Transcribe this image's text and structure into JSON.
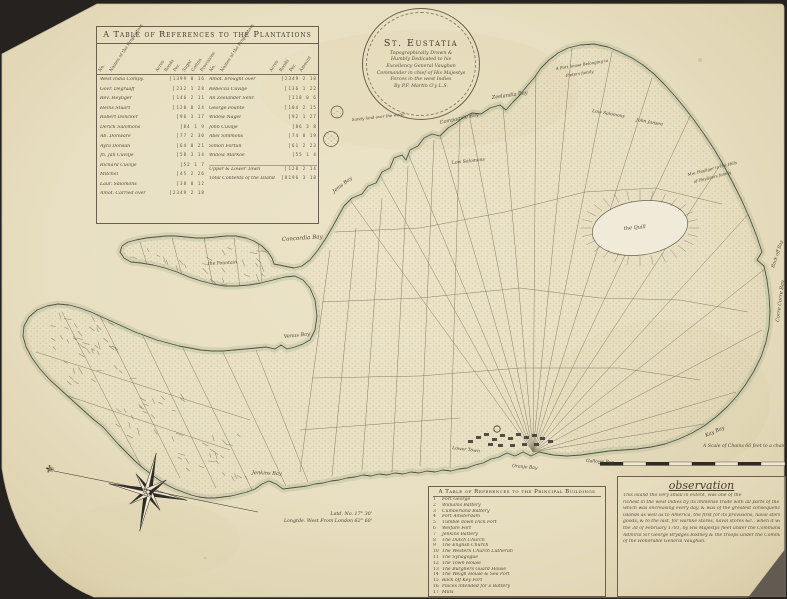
{
  "colors": {
    "paper": "#e9e0c4",
    "ink": "#4d4536",
    "backdrop": "#262220",
    "coast_wash": "#9fae8d"
  },
  "plantation_table": {
    "title": "A Table of References to the Plantations",
    "column_headers": [
      "No.",
      "Names of the Proprietors",
      "Acres",
      "Roods",
      "Per.",
      "Sugar",
      "Cotton",
      "Provisions",
      "No.",
      "Names of the Proprietors",
      "Acres",
      "Roods",
      "Per.",
      "Amount"
    ],
    "left_rows": [
      {
        "name": "West India Compy.",
        "nums": "1399 0 16"
      },
      {
        "name": "Govr. Degraaff",
        "nums": "232 1 28"
      },
      {
        "name": "Rev. Heyliger",
        "nums": "146 2 11"
      },
      {
        "name": "Heins Stuart",
        "nums": "128 0 24"
      },
      {
        "name": "Robert Doncker",
        "nums": "96 3 17"
      },
      {
        "name": "Derick Salomons",
        "nums": "84 1 9"
      },
      {
        "name": "Ab. Donware",
        "nums": "77 2 30"
      },
      {
        "name": "Ayra Donsan",
        "nums": "64 0 21"
      },
      {
        "name": "Jn. Jan Cuvilje",
        "nums": "58 3 14"
      },
      {
        "name": "Richard Cuvilje",
        "nums": "52 1 7"
      },
      {
        "name": "Mitchel",
        "nums": "45 2 26"
      },
      {
        "name": "Laur. Salomons",
        "nums": "38 0 12"
      },
      {
        "name": "Amot. Carried over",
        "nums": "2349 2 18"
      }
    ],
    "right_rows": [
      {
        "name": "Amot. brought over",
        "nums": "2349 2 18"
      },
      {
        "name": "Rebecca Cuvilje",
        "nums": "136 1 22"
      },
      {
        "name": "An Zeelander Senr.",
        "nums": "118 0 6"
      },
      {
        "name": "George Founte",
        "nums": "104 2 15"
      },
      {
        "name": "Widow Nagel",
        "nums": "92 1 27"
      },
      {
        "name": "John Cuvilje",
        "nums": "86 3 8"
      },
      {
        "name": "Abel Simmons",
        "nums": "74 0 19"
      },
      {
        "name": "Simon Fortun",
        "nums": "61 2 23"
      },
      {
        "name": "Widow Markoe",
        "nums": "55 1 4"
      }
    ],
    "footer_rows": [
      {
        "name": "Upper & Lower Town",
        "nums": "128 2 14"
      },
      {
        "name": "Total Contents of the Island",
        "nums": "8196 3 18"
      }
    ]
  },
  "cartouche": {
    "title": "St. Eustatia",
    "lines": [
      "Topographically Drawn &",
      "Humbly Dedicated to his",
      "Excellency General Vaughan",
      "Commander in chief of His Majestys",
      "Forces in the west Indies",
      "By P.F. Martin G'y L.S."
    ]
  },
  "map_labels": [
    {
      "text": "Zeelandia Bay"
    },
    {
      "text": "Compagnie Bay"
    },
    {
      "text": "Jems Bay"
    },
    {
      "text": "Concordia Bay"
    },
    {
      "text": "Venus Bay"
    },
    {
      "text": "Jenkins Bay"
    },
    {
      "text": "Corre Corre Bay"
    },
    {
      "text": "Back off Bay"
    },
    {
      "text": "Kay Bay"
    },
    {
      "text": "Gallows Bay"
    },
    {
      "text": "Oranje Bay"
    },
    {
      "text": "Lower Town"
    },
    {
      "text": "the Quill"
    },
    {
      "text": "Low Salomons"
    },
    {
      "text": "Low Salomons"
    },
    {
      "text": "John Jansen"
    },
    {
      "text": "the Fountain"
    },
    {
      "text": "Sandy land over the water"
    },
    {
      "text": "Mw. Heyliger in the Hills"
    },
    {
      "text": "of Heyligers family"
    },
    {
      "text": "A Fort house Belonging to"
    },
    {
      "text": "Pieters family"
    }
  ],
  "compass": {
    "fleur": "⚜"
  },
  "scale_bar": {
    "label": "A Scale of Chains 66 feet to a chain"
  },
  "coordinates": {
    "latitude": "Latd. No. 17° 30'",
    "longitude": "Longtde. West From London 62° 60'"
  },
  "buildings_table": {
    "title": "A Table of References to the Principal Buildings",
    "items": [
      {
        "no": "1",
        "label": "Fort George"
      },
      {
        "no": "2",
        "label": "Williams Battery"
      },
      {
        "no": "3",
        "label": "Cumberland Battery"
      },
      {
        "no": "4",
        "label": "Fort Amsterdam"
      },
      {
        "no": "5",
        "label": "Tumble down Dick Fort"
      },
      {
        "no": "6",
        "label": "Welfare Fort"
      },
      {
        "no": "7",
        "label": "Jenkins Battery"
      },
      {
        "no": "8",
        "label": "The Dutch Church"
      },
      {
        "no": "9",
        "label": "The English Church"
      },
      {
        "no": "10",
        "label": "The Western Church Lutheran"
      },
      {
        "no": "11",
        "label": "The Synagogue"
      },
      {
        "no": "12",
        "label": "The Town House"
      },
      {
        "no": "13",
        "label": "The Burghers Guard House"
      },
      {
        "no": "14",
        "label": "The Weigh House & Sea Port"
      },
      {
        "no": "15",
        "label": "Back off Key Fort"
      },
      {
        "no": "16",
        "label": "Places intended for a Battery"
      },
      {
        "no": "17",
        "label": "Mills"
      }
    ]
  },
  "observation": {
    "title": "observation",
    "lines": [
      "This island tho very small in extent, was one of the",
      "richest in the west indies by its immense trade with all parts of the world,",
      "which was encreasing every day, & was of the greatest consequence to the Dutch",
      "islands as well as to America, the first for its provisions, naval stores & dry",
      "goods, & to the last, for warlike stores, naval stores &c., when it was conquered on",
      "the 3d of February 1781, by His Majestys fleet under the Command of",
      "Admiral Sir George Brydges Rodney & the troops under the Command",
      "of the Honorable General Vaughan."
    ]
  }
}
